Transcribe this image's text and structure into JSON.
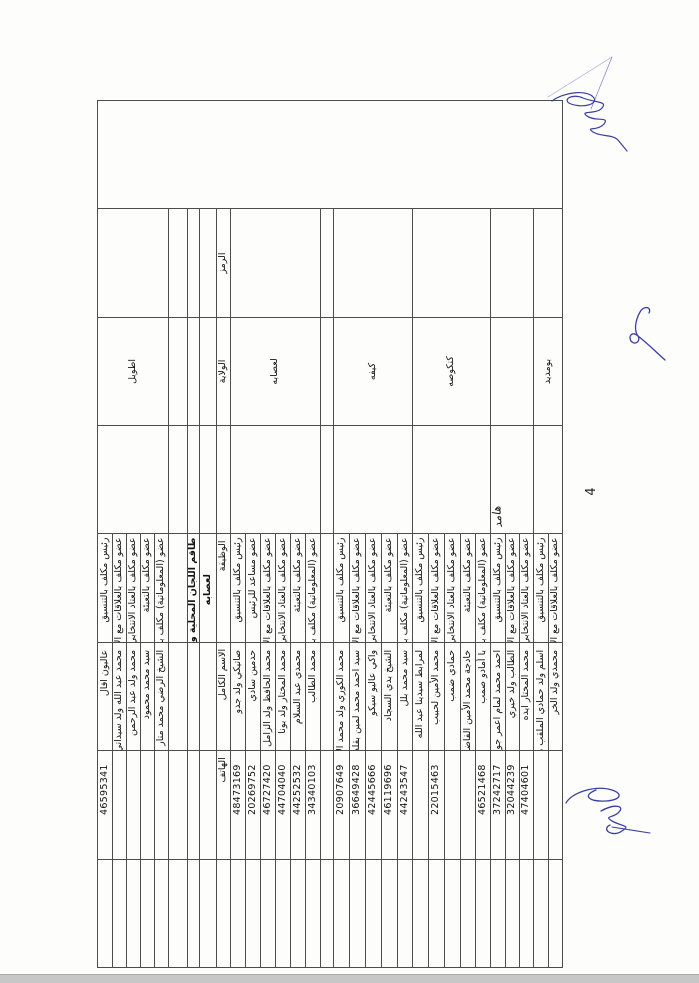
{
  "page": {
    "number": "4"
  },
  "document": {
    "title_line1": "طاقم اللجان المحلية والجهوية",
    "title_line2": "لعصابه"
  },
  "table": {
    "headers": {
      "code": "الرمز",
      "wilaya": "الولاية",
      "position": "الوظيفة",
      "full_name": "الاسم الكامل",
      "phone": "الهاتف"
    },
    "continuation_group": {
      "wilaya": "اطويل",
      "members": [
        {
          "position": "رئيس مكلف بالتنسيق",
          "full_name": "عاليون افال",
          "phone": "46595341"
        },
        {
          "position": "عضو مكلف بالعلاقات مع الإدارة و اللجان الانتخابية",
          "full_name": "محمد عبد الله ولد سيداتي",
          "phone": ""
        },
        {
          "position": "عضو مكلف بالعتاد الانتخابي و عمليات الاقتراع",
          "full_name": "محمد ولد عبد الرحمن",
          "phone": ""
        },
        {
          "position": "عضو مكلف بالتعبئة",
          "full_name": "سيد محمد محمود",
          "phone": ""
        },
        {
          "position": "عضو (المعلوماتية) مكلف بمعالجة معطيات الاقتراع",
          "full_name": "الشيخ الرضي محمد متار",
          "phone": ""
        }
      ]
    },
    "groups": [
      {
        "wilaya": "لعصابه",
        "members": [
          {
            "position": "رئيس مكلف بالتنسيق",
            "full_name": "صاتيكي ولد جدو",
            "phone": "48473169"
          },
          {
            "position": "عضو مساعد للرئيس",
            "full_name": "حدمين سادي",
            "phone": "20269752"
          },
          {
            "position": "عضو مكلف بالعلاقات مع الإدارة و اللجان الانتخابية",
            "full_name": "محمد الحافظ ولد الزامل",
            "phone": "46727420"
          },
          {
            "position": "عضو مكلف بالعتاد الانتخابي و عمليات الاقتراع",
            "full_name": "محمد المختار ولد بونا",
            "phone": "44704040"
          },
          {
            "position": "عضو مكلف بالتعبئة",
            "full_name": "محمدي عبد السلام",
            "phone": "44252532"
          },
          {
            "position": "عضو (المعلوماتية) مكلف بمعالجة معطيات الاقتراع",
            "full_name": "محمد الطالب",
            "phone": "34340103"
          }
        ]
      },
      {
        "wilaya": "كيفه",
        "members": [
          {
            "position": "رئيس مكلف بالتنسيق",
            "full_name": "محمد الكوري ولد محمد الأمين احمدو",
            "phone": "20907649"
          },
          {
            "position": "عضو مكلف بالعلاقات مع الإدارة و اللجان الانتخابية",
            "full_name": "سيد احمد محمد لمين بقله",
            "phone": "36649428"
          },
          {
            "position": "عضو مكلف بالعتاد الانتخابي و عمليات الاقتراع",
            "full_name": "واكي عاليو سيكو",
            "phone": "42445666"
          },
          {
            "position": "عضو مكلف بالتعبئة",
            "full_name": "الشيخ بدي السجاد",
            "phone": "46119696"
          },
          {
            "position": "عضو (المعلوماتية) مكلف بمعالجة معطيات الاقتراع",
            "full_name": "سيد محمد بلل",
            "phone": "44243547"
          }
        ]
      },
      {
        "wilaya": "كنكوصه",
        "members": [
          {
            "position": "رئيس مكلف بالتنسيق",
            "full_name": "لمرابط سيدينا عبد الله",
            "phone": ""
          },
          {
            "position": "عضو مكلف بالعلاقات مع الإدارة و اللجان الانتخابية",
            "full_name": "محمد الأمين لحبيب",
            "phone": "22015463"
          },
          {
            "position": "عضو مكلف بالعتاد الانتخابي و عمليات الاقتراع",
            "full_name": "حمادي ضمب",
            "phone": ""
          },
          {
            "position": "عضو مكلف بالتعبئة",
            "full_name": "خادجة محمد الأمين الفاضل",
            "phone": ""
          },
          {
            "position": "عضو (المعلوماتية) مكلف بمعالجة معطيات الاقتراع",
            "full_name": "با أمادو صمب",
            "phone": "46521468"
          }
        ]
      },
      {
        "wilaya": "",
        "handwritten_wilaya": "هامد",
        "members": [
          {
            "position": "رئيس مكلف بالتنسيق",
            "full_name": "احمد محمد لمام اعمر جوده",
            "phone": "37242717"
          },
          {
            "position": "عضو مكلف بالعلاقات مع الإدارة و اللجان الانتخابية",
            "full_name": "الطالب ولد خيري",
            "phone": "32044239"
          },
          {
            "position": "عضو مكلف بالعتاد الانتخابي و عمليات الاقتراع",
            "full_name": "محمد المختار ايده",
            "phone": "47404601"
          }
        ]
      },
      {
        "wilaya": "بومديد",
        "members": [
          {
            "position": "رئيس مكلف بالتنسيق",
            "full_name": "اسلم ولد حمادي الملقب محمد الأمين",
            "phone": ""
          },
          {
            "position": "عضو مكلف بالعلاقات مع الإدارة و اللجان الانتخابية",
            "full_name": "محمدي ولد الخر",
            "phone": ""
          }
        ]
      }
    ]
  },
  "annotations": {
    "ink_color": "#3b3f9f",
    "ink_marks": [
      "paraph-top-right",
      "squiggle-middle-right",
      "signature-bottom"
    ]
  }
}
